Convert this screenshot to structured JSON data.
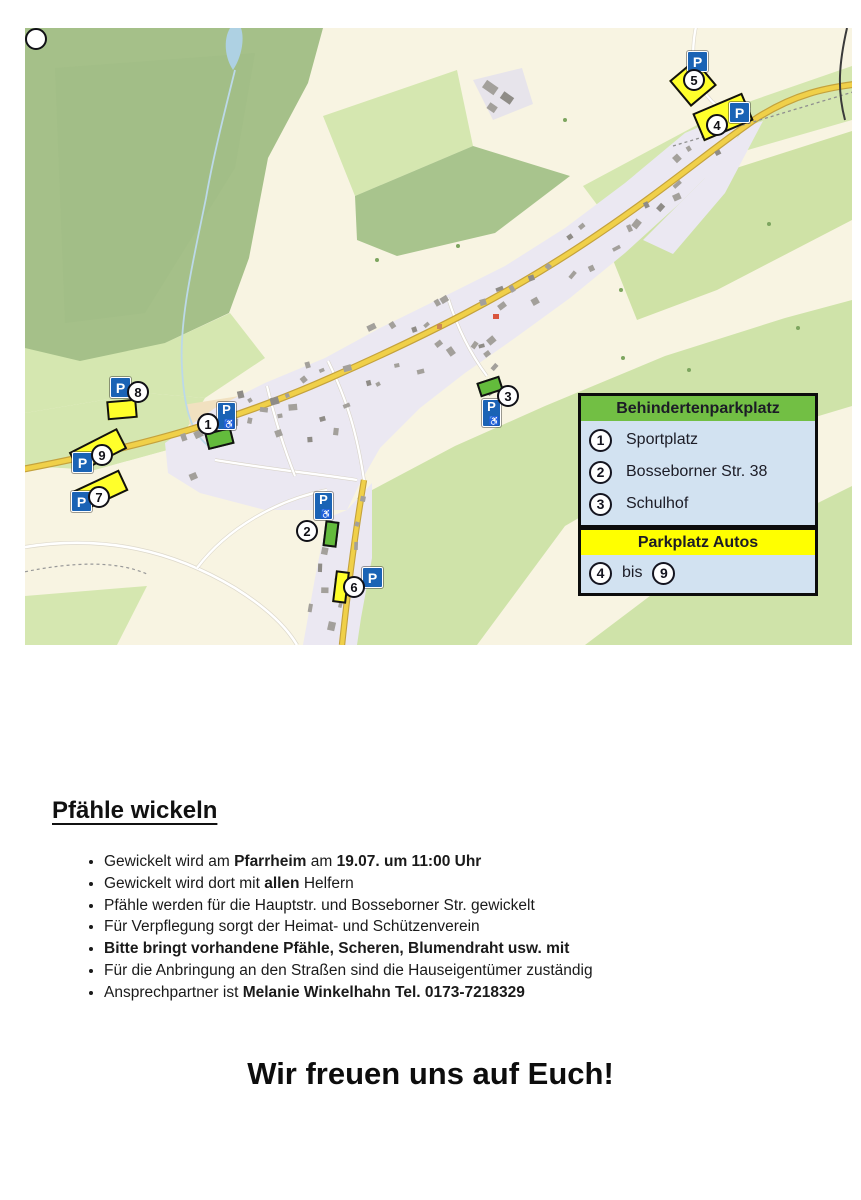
{
  "map": {
    "p_label": "P",
    "wheelchair_symbol": "♿",
    "legend": {
      "disabled": {
        "title": "Behindertenparkplatz",
        "items": [
          {
            "num": "1",
            "label": "Sportplatz"
          },
          {
            "num": "2",
            "label": "Bosseborner Str. 38"
          },
          {
            "num": "3",
            "label": "Schulhof"
          }
        ]
      },
      "cars": {
        "title": "Parkplatz Autos",
        "from": "4",
        "sep": "bis",
        "to": "9"
      }
    },
    "markers": {
      "m1": {
        "num": "1",
        "kind": "behindertenparkplatz"
      },
      "m2": {
        "num": "2",
        "kind": "behindertenparkplatz"
      },
      "m3": {
        "num": "3",
        "kind": "behindertenparkplatz"
      },
      "m4": {
        "num": "4",
        "kind": "parkplatz-autos"
      },
      "m5": {
        "num": "5",
        "kind": "parkplatz-autos"
      },
      "m6": {
        "num": "6",
        "kind": "parkplatz-autos"
      },
      "m7": {
        "num": "7",
        "kind": "parkplatz-autos"
      },
      "m8": {
        "num": "8",
        "kind": "parkplatz-autos"
      },
      "m9": {
        "num": "9",
        "kind": "parkplatz-autos"
      }
    },
    "colors": {
      "legend_green": "#72bf44",
      "legend_yellow": "#ffff00",
      "legend_body": "#d2e2f1",
      "p_blue": "#1a63b5",
      "marker_yellow": "#ffff2b",
      "marker_green": "#63bb3c"
    }
  },
  "content": {
    "heading": "Pfähle wickeln",
    "bullets": [
      {
        "segments": [
          {
            "text": "Gewickelt wird am ",
            "bold": false
          },
          {
            "text": "Pfarrheim",
            "bold": true
          },
          {
            "text": " am ",
            "bold": false
          },
          {
            "text": "19.07. um 11:00 Uhr",
            "bold": true
          }
        ]
      },
      {
        "segments": [
          {
            "text": "Gewickelt wird dort mit ",
            "bold": false
          },
          {
            "text": "allen",
            "bold": true
          },
          {
            "text": " Helfern",
            "bold": false
          }
        ]
      },
      {
        "segments": [
          {
            "text": "Pfähle werden für die Hauptstr. und Bosseborner Str. gewickelt",
            "bold": false
          }
        ]
      },
      {
        "segments": [
          {
            "text": "Für Verpflegung sorgt der Heimat- und Schützenverein",
            "bold": false
          }
        ]
      },
      {
        "segments": [
          {
            "text": "Bitte bringt vorhandene Pfähle, Scheren, Blumendraht usw. mit",
            "bold": true
          }
        ]
      },
      {
        "segments": [
          {
            "text": "Für die Anbringung an den Straßen sind die Hauseigentümer zuständig",
            "bold": false
          }
        ]
      },
      {
        "segments": [
          {
            "text": "Ansprechpartner ist ",
            "bold": false
          },
          {
            "text": "Melanie Winkelhahn Tel. 0173-7218329",
            "bold": true
          }
        ]
      }
    ],
    "closing": "Wir freuen uns auf Euch!"
  }
}
